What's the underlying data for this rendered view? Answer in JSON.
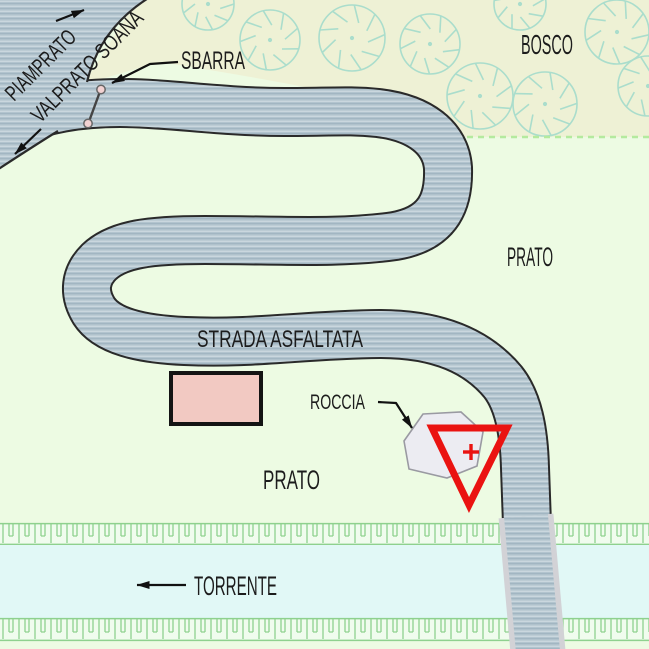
{
  "map": {
    "title_labels_note": "hand-drawn site plan",
    "labels": {
      "piamprato": "PIAMPRATO",
      "valprato_soana": "VALPRATO SOANA",
      "sbarra": "SBARRA",
      "bosco": "BOSCO",
      "prato_upper": "PRATO",
      "strada_asfaltata": "STRADA ASFALTATA",
      "roccia": "ROCCIA",
      "prato_lower": "PRATO",
      "torrente": "TORRENTE"
    },
    "colors": {
      "road": "#b2c4ce",
      "road_outline": "#2a2a2a",
      "prato": "#edfbe3",
      "bosco": "#eef1d5",
      "tree": "#aaddcc",
      "boundary_dash": "#b4ea9e",
      "stream": "#e1f8f6",
      "bank_fill": "#f0fcee",
      "bank_line": "#8ed18e",
      "bridge_edge": "#d2d2d6",
      "building_fill": "#f2c9c2",
      "building_outline": "#141414",
      "rock_fill": "#ececf2",
      "rock_outline": "#9a9aa2",
      "marker_red": "#ea1311",
      "barrier_fill": "#f2d2d2",
      "barrier_outline": "#666666",
      "text": "#1c1c1c",
      "leader": "#111111"
    }
  }
}
